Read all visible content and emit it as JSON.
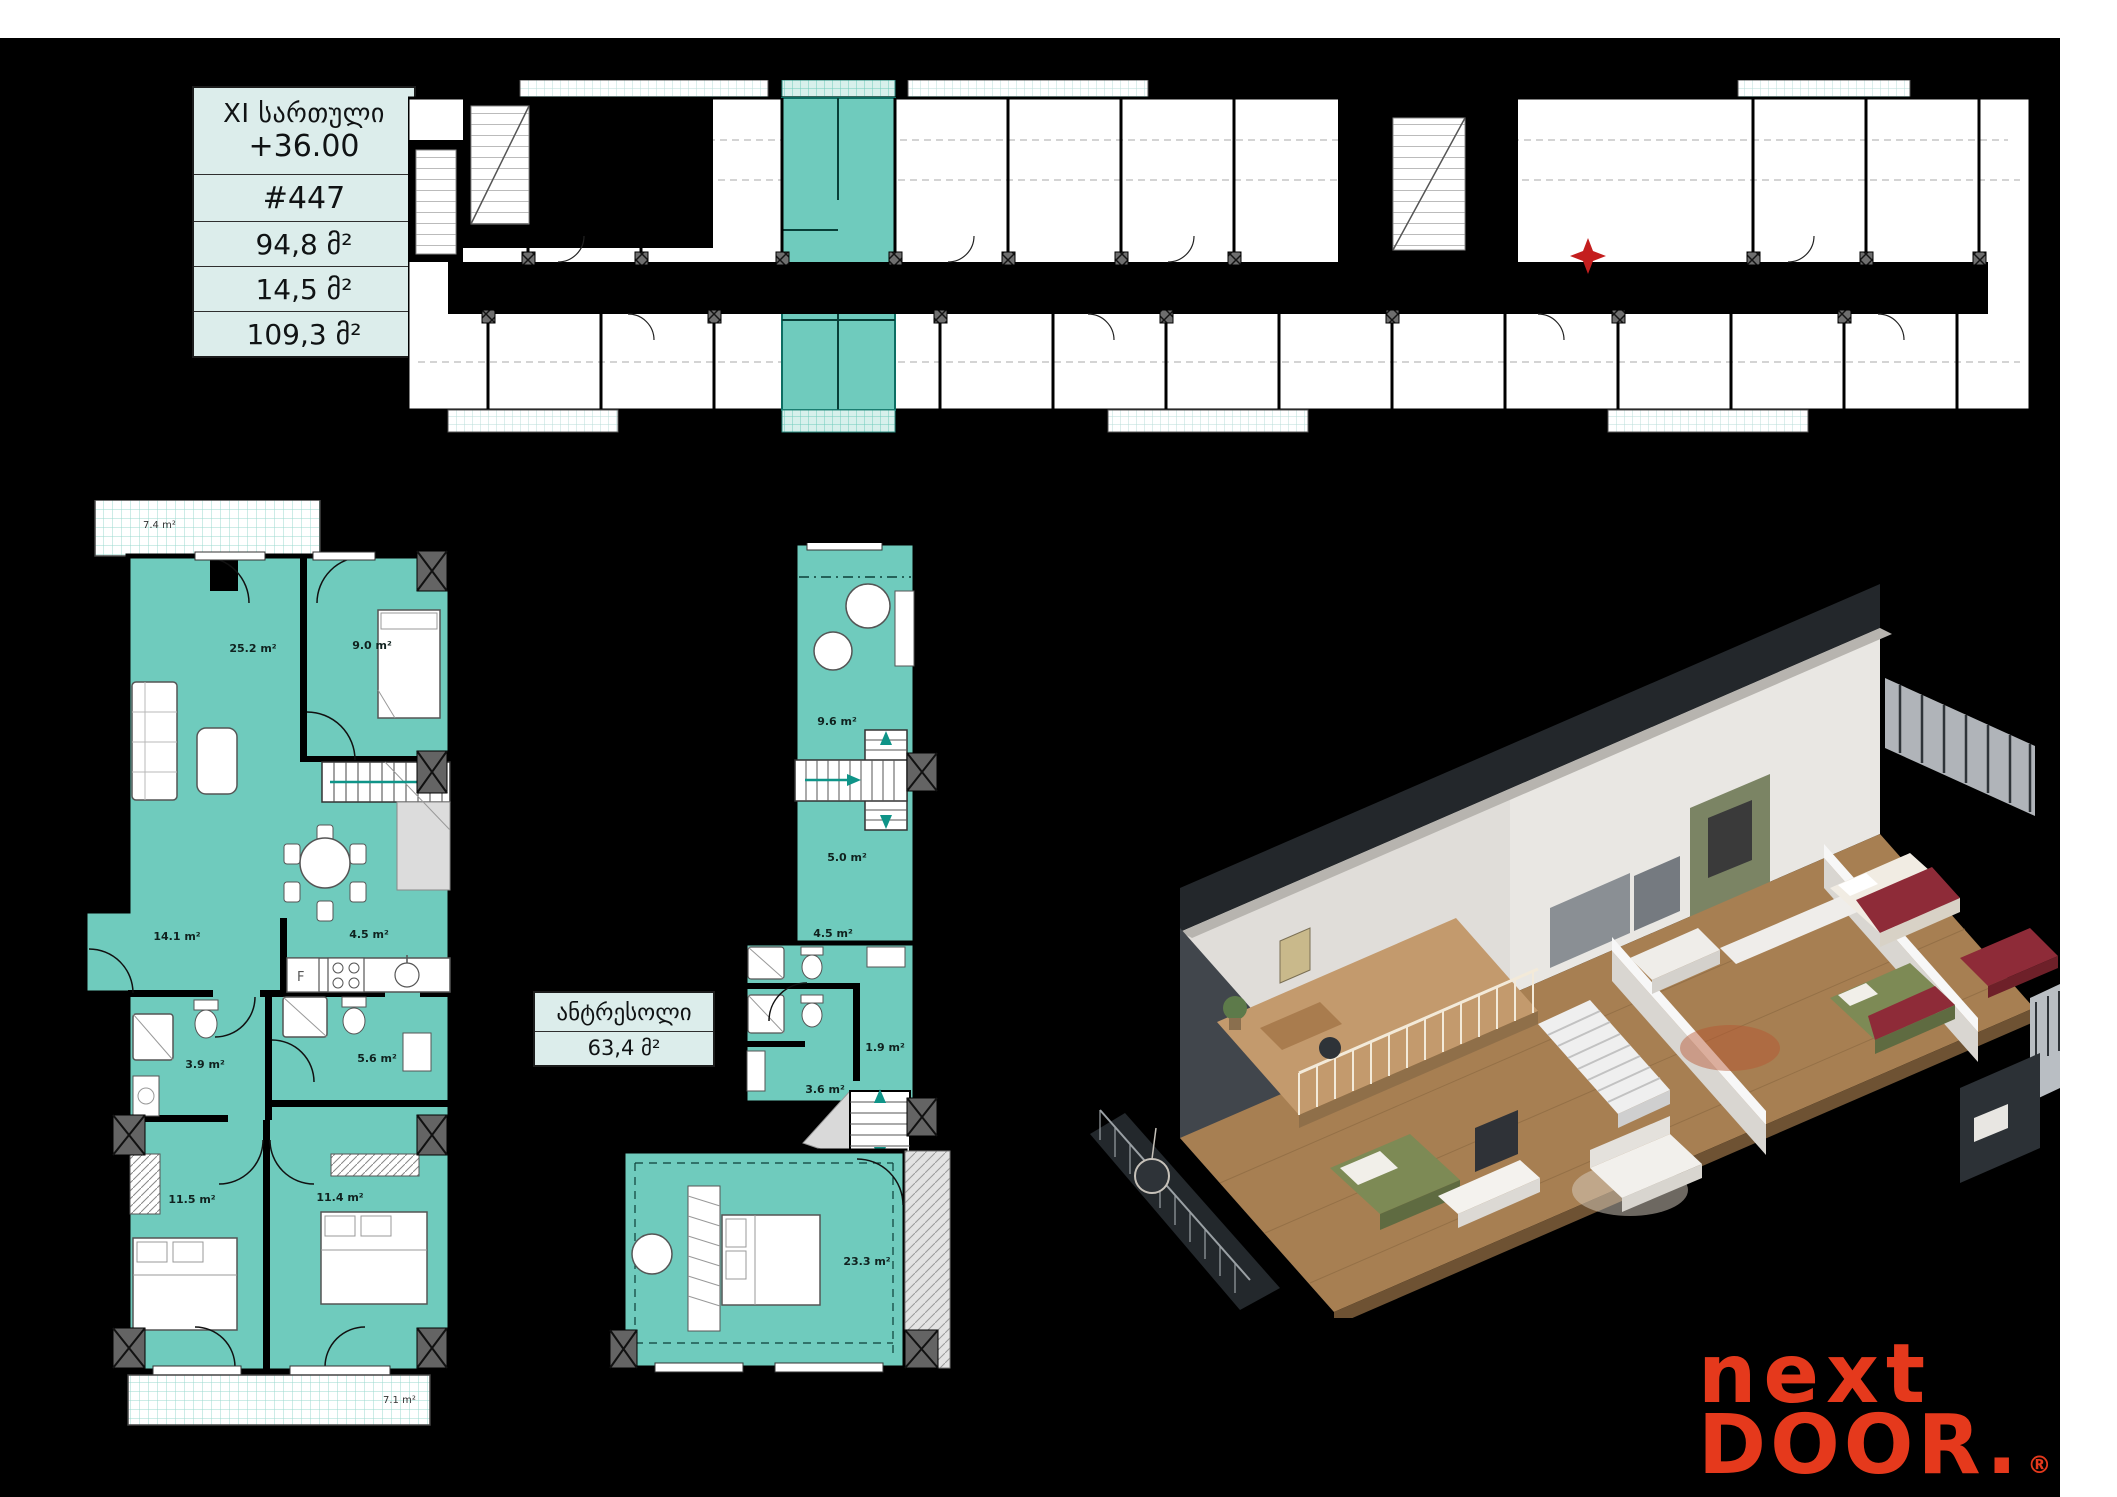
{
  "page": {
    "background": "#ffffff",
    "canvas_color": "#000000"
  },
  "info_box": {
    "floor_label": "XI სართული",
    "elevation": "+36.00",
    "unit_number": "#447",
    "area_apartment": "94,8 მ²",
    "area_balcony": "14,5 მ²",
    "area_total": "109,3 მ²"
  },
  "antresol_box": {
    "title": "ანტრესოლი",
    "area": "63,4 მ²"
  },
  "lower_plan": {
    "rooms": [
      {
        "name": "balcony-top",
        "label": "7.4 m²"
      },
      {
        "name": "living-room",
        "label": "25.2 m²"
      },
      {
        "name": "bedroom-small",
        "label": "9.0 m²"
      },
      {
        "name": "hall",
        "label": "14.1 m²"
      },
      {
        "name": "kitchen",
        "label": "4.5 m²"
      },
      {
        "name": "bathroom-1",
        "label": "3.9 m²"
      },
      {
        "name": "bathroom-2",
        "label": "5.6 m²"
      },
      {
        "name": "bedroom-1",
        "label": "11.5 m²"
      },
      {
        "name": "bedroom-2",
        "label": "11.4 m²"
      },
      {
        "name": "balcony-bottom",
        "label": "7.1 m²"
      }
    ],
    "fridge_label": "F"
  },
  "mezzanine_plan": {
    "rooms": [
      {
        "name": "laundry",
        "label": "9.6 m²"
      },
      {
        "name": "hall",
        "label": "5.0 m²"
      },
      {
        "name": "bath-hall",
        "label": "4.5 m²"
      },
      {
        "name": "closet",
        "label": "1.9 m²"
      },
      {
        "name": "bathroom",
        "label": "3.6 m²"
      },
      {
        "name": "bedroom",
        "label": "23.3 m²"
      }
    ]
  },
  "colors": {
    "unit_highlight": "#6fcbbd",
    "info_box_bg": "#dcedeb",
    "logo_red": "#e5391c"
  },
  "logo": {
    "line1": "next",
    "line2": "DOOR",
    "dot": ".",
    "registered": "®"
  },
  "watermark": "GSPublisherVersion 0.0.100.97"
}
